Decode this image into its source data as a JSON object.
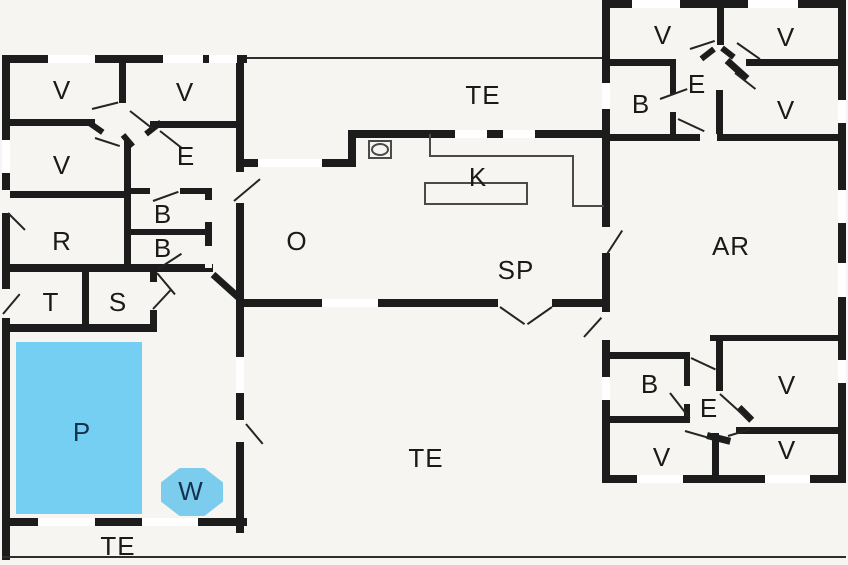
{
  "title": "House floor plan",
  "colors": {
    "background": "#f6f5f1",
    "wall": "#1c1c1c",
    "pool": "#74cff3",
    "whirlpool": "#7cccee",
    "window_opening": "#ffffff",
    "label_text": "#1a1a1a",
    "pool_label_text": "#14324e"
  },
  "rooms": [
    {
      "id": "v-topleft-1",
      "label": "V"
    },
    {
      "id": "v-topleft-2",
      "label": "V"
    },
    {
      "id": "e-left",
      "label": "E"
    },
    {
      "id": "v-left-3",
      "label": "V"
    },
    {
      "id": "r-left",
      "label": "R"
    },
    {
      "id": "b-left-1",
      "label": "B"
    },
    {
      "id": "b-left-2",
      "label": "B"
    },
    {
      "id": "t-room",
      "label": "T"
    },
    {
      "id": "s-room",
      "label": "S"
    },
    {
      "id": "pool",
      "label": "P"
    },
    {
      "id": "whirlpool",
      "label": "W"
    },
    {
      "id": "terrace-bottom-left",
      "label": "TE"
    },
    {
      "id": "terrace-top",
      "label": "TE"
    },
    {
      "id": "living-o",
      "label": "O"
    },
    {
      "id": "kitchen-k",
      "label": "K"
    },
    {
      "id": "dining-sp",
      "label": "SP"
    },
    {
      "id": "terrace-bottom",
      "label": "TE"
    },
    {
      "id": "ar-room",
      "label": "AR"
    },
    {
      "id": "v-topright-1",
      "label": "V"
    },
    {
      "id": "v-topright-2",
      "label": "V"
    },
    {
      "id": "e-topright",
      "label": "E"
    },
    {
      "id": "b-topright",
      "label": "B"
    },
    {
      "id": "v-topright-3",
      "label": "V"
    },
    {
      "id": "b-bottomright",
      "label": "B"
    },
    {
      "id": "v-bottomright-1",
      "label": "V"
    },
    {
      "id": "e-bottomright",
      "label": "E"
    },
    {
      "id": "v-bottomright-2",
      "label": "V"
    },
    {
      "id": "v-bottomright-3",
      "label": "V"
    }
  ]
}
